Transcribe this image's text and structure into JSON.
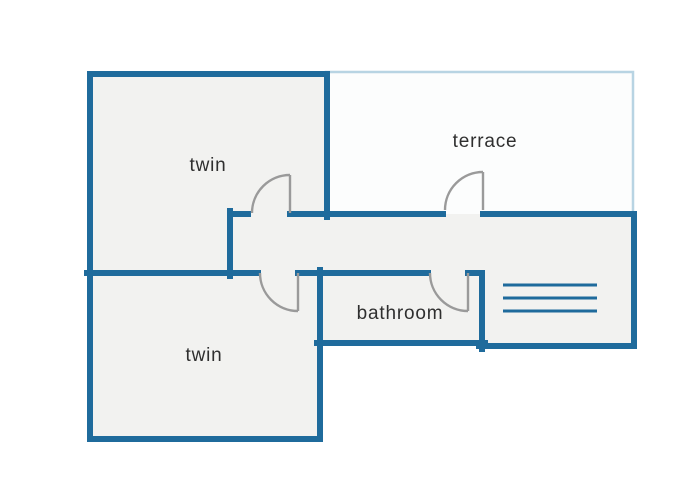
{
  "floor_plan": {
    "rooms": {
      "twin_top": {
        "label": "twin"
      },
      "terrace": {
        "label": "terrace"
      },
      "twin_bottom": {
        "label": "twin"
      },
      "bathroom": {
        "label": "bathroom"
      }
    },
    "symbols": {
      "stairs_lines": 3,
      "door_count": 4
    },
    "colors": {
      "wall": "#1f6b9c",
      "room_fill": "#f2f2f0",
      "terrace_fill": "#fcfdfd",
      "terrace_border": "#b8d4e3",
      "door": "#9a9a9a",
      "text": "#2f2f2f",
      "background": "#ffffff"
    }
  }
}
